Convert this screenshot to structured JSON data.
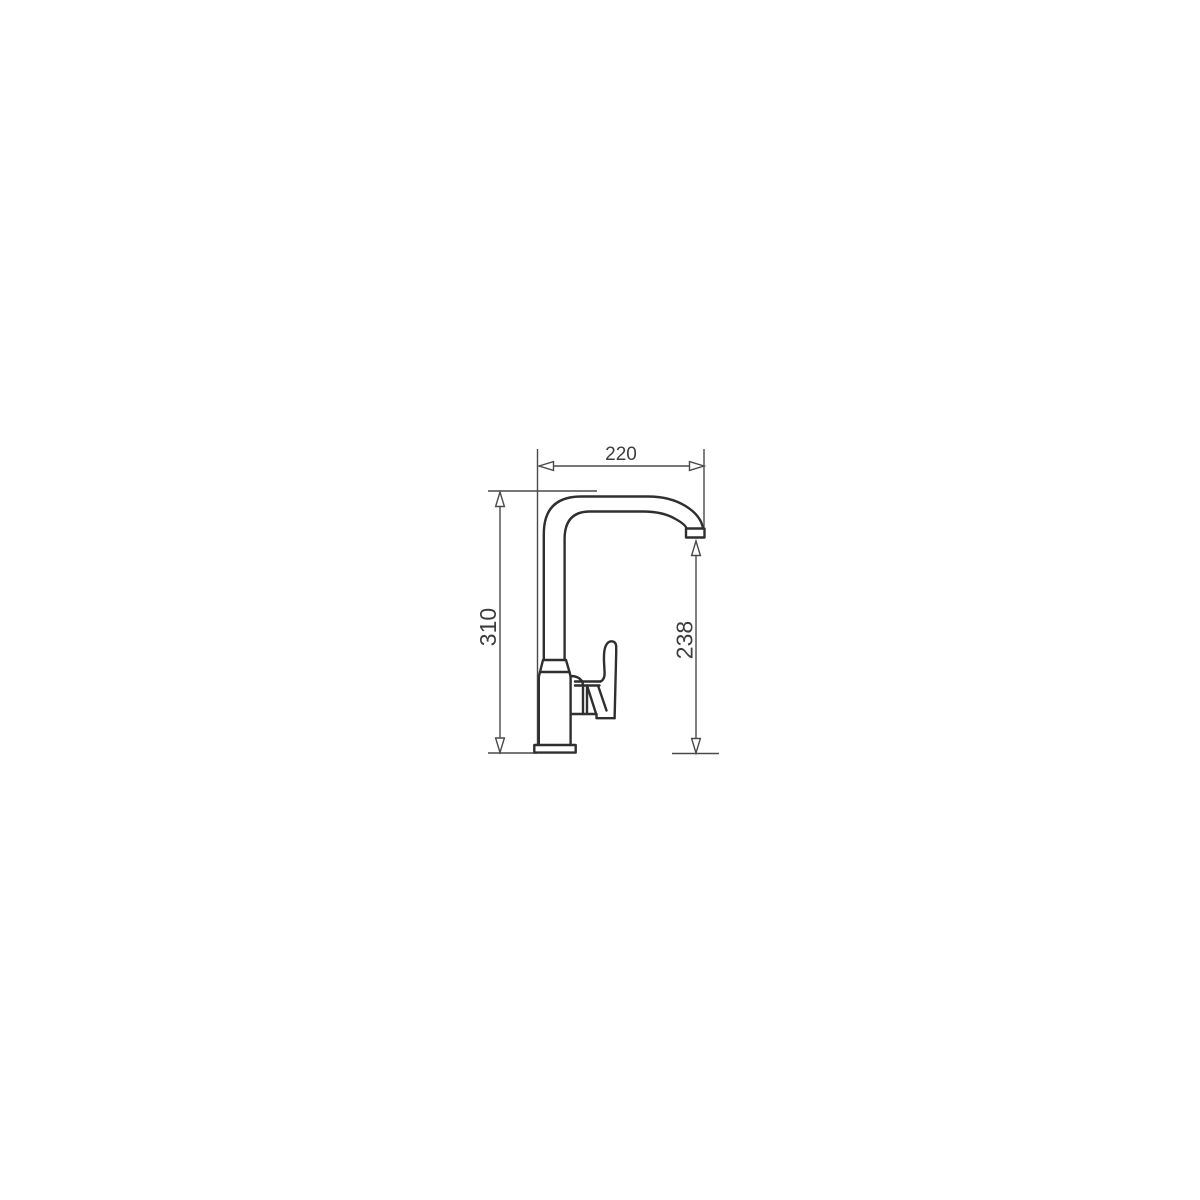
{
  "drawing": {
    "kind": "technical-dimension-drawing",
    "dimensions": {
      "spout_reach": {
        "label": "220",
        "orientation": "horizontal"
      },
      "total_height": {
        "label": "310",
        "orientation": "vertical"
      },
      "spout_height": {
        "label": "238",
        "orientation": "vertical"
      }
    },
    "colors": {
      "outline": "#2f2f2f",
      "dimension_lines": "#4a4a4a",
      "label_text": "#3d3d3d",
      "background": "#ffffff"
    }
  }
}
